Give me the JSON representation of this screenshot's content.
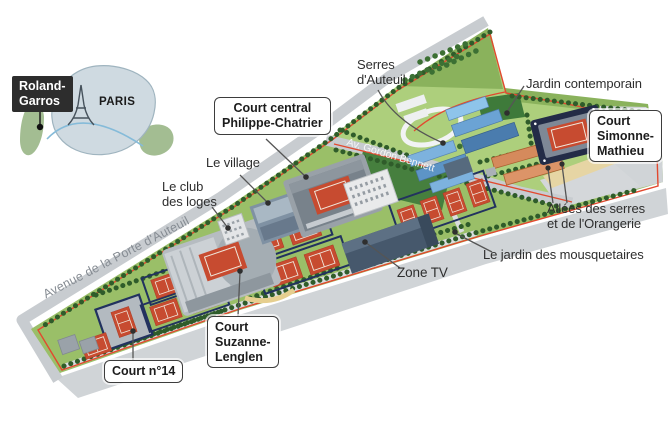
{
  "title": "Roland-Garros site map infographic",
  "inset": {
    "marker_label": "Roland-\nGarros",
    "city_label": "PARIS"
  },
  "roads": {
    "avenue_porte_auteuil": "Avenue de la Porte d'Auteuil",
    "av_gordon_bennett": "Av. Gordon Bennett"
  },
  "plain_labels": {
    "serres_auteuil": "Serres\nd'Auteuil",
    "jardin_contemporain": "Jardin contemporain",
    "le_village": "Le village",
    "club_loges": "Le club\ndes loges",
    "allees_serres_orangerie": "Allées des serres\net de l'Orangerie",
    "jardin_mousquetaires": "Le jardin des mousquetaires",
    "zone_tv": "Zone TV"
  },
  "boxed_labels": {
    "court_central": "Court central\nPhilippe-Chatrier",
    "court_simonne_mathieu": "Court\nSimonne-\nMathieu",
    "court_suzanne_lenglen": "Court\nSuzanne-\nLenglen",
    "court_14": "Court n°14"
  },
  "colors": {
    "lawn": "#9abf68",
    "lawn_light": "#adcf7c",
    "lawn_dark": "#467f3e",
    "trees": "#2f5c2a",
    "clay_court": "#c74b30",
    "court_border_navy": "#22325f",
    "road_gray": "#c8ccd0",
    "site_path_red": "#e2492f",
    "greenhouse_blue": "#5d94c6",
    "orangerie": "#d58a5c",
    "inset_fill": "#cfdae1",
    "seine_blue": "#85bbd9",
    "tag_black": "#2d2d2d"
  }
}
